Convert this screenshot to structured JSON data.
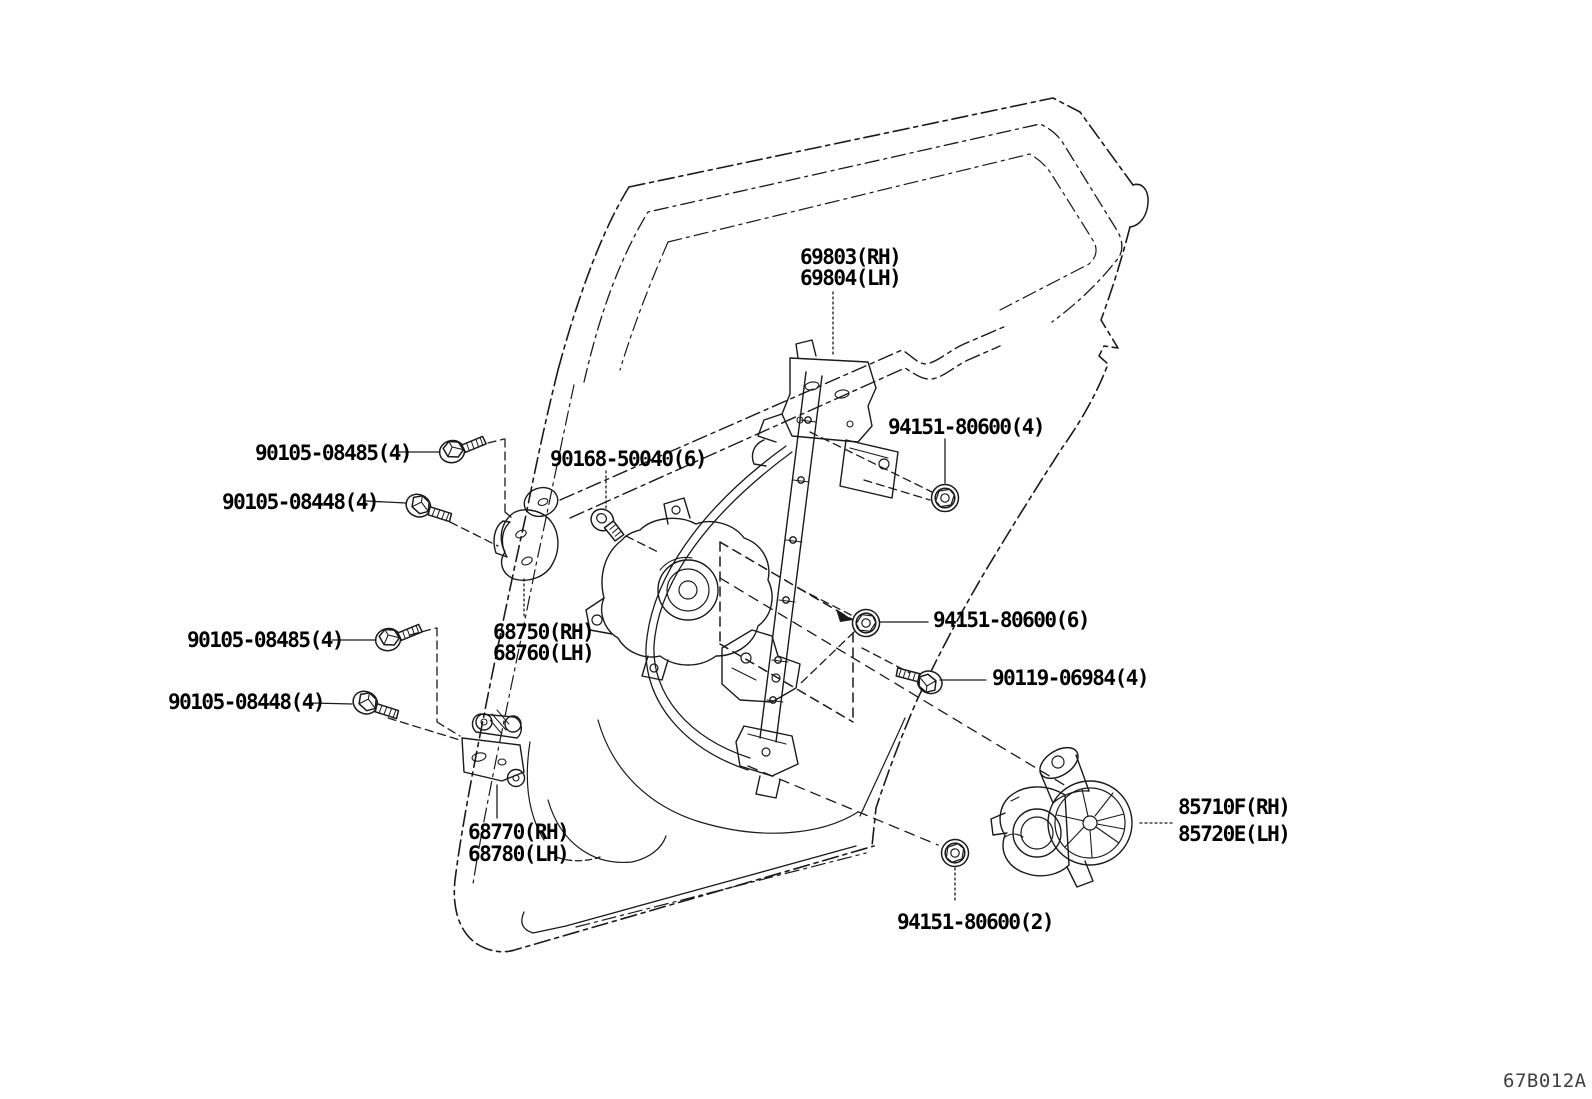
{
  "diagram": {
    "code": "67B012A",
    "background_color": "#ffffff",
    "line_color": "#1a1a1a",
    "code_color": "#3f3f3f",
    "subject": "rear door window regulator and hinge exploded parts diagram"
  },
  "labels": {
    "window_guide": {
      "line1": "69803(RH)",
      "line2": "69804(LH)"
    },
    "bolt_front_upper_1": "90105-08485(4)",
    "bolt_front_upper_2": "90105-08448(4)",
    "screw_regulator": "90168-50040(6)",
    "nut_upper": "94151-80600(4)",
    "hinge_upper": {
      "line1": "68750(RH)",
      "line2": "68760(LH)"
    },
    "bolt_front_lower_1": "90105-08485(4)",
    "bolt_front_lower_2": "90105-08448(4)",
    "nut_mid": "94151-80600(6)",
    "bolt_rear": "90119-06984(4)",
    "hinge_lower": {
      "line1": "68770(RH)",
      "line2": "68780(LH)"
    },
    "motor": {
      "line1": "85710F(RH)",
      "line2": "85720E(LH)"
    },
    "nut_lower": "94151-80600(2)"
  }
}
